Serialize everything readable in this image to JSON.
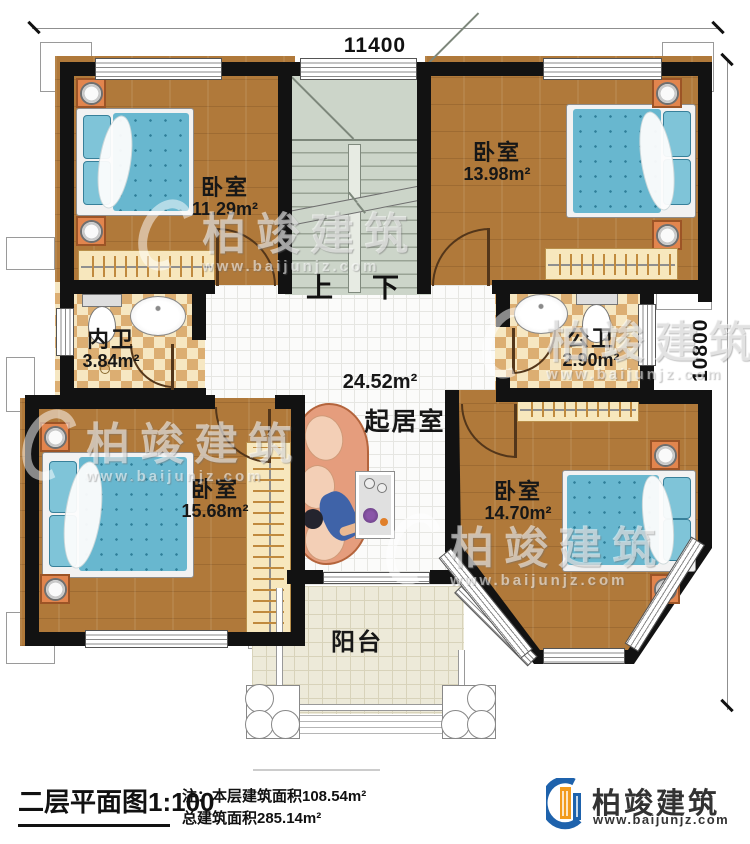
{
  "plan": {
    "dim_width": "11400",
    "dim_height": "10800",
    "stair_up": "上",
    "stair_down": "下",
    "rooms": {
      "bedroom_tl": {
        "name": "卧室",
        "area": "11.29m²"
      },
      "bedroom_tr": {
        "name": "卧室",
        "area": "13.98m²"
      },
      "bath_inner": {
        "name": "内卫",
        "area": "3.84m²"
      },
      "bath_public": {
        "name": "公卫",
        "area": "2.90m²"
      },
      "living": {
        "name": "起居室",
        "area": "24.52m²"
      },
      "bedroom_bl": {
        "name": "卧室",
        "area": "15.68m²"
      },
      "bedroom_br": {
        "name": "卧室",
        "area": "14.70m²"
      },
      "balcony": {
        "name": "阳台"
      }
    }
  },
  "watermark": {
    "brand": "柏竣建筑",
    "site": "www.baijunjz.com"
  },
  "footer": {
    "title": "二层平面图",
    "scale": "1:100",
    "note1": "注：本层建筑面积108.54m²",
    "note2": "总建筑面积285.14m²",
    "brand": "柏竣建筑",
    "site": "www.baijunjz.com"
  },
  "colors": {
    "wall": "#121212",
    "wood_floor": "#b0793a",
    "stair": "#ccd5c9",
    "bed_blue": "#68b7cf",
    "nightstand_orange": "#e2854e",
    "bath_tile": "#dcae72",
    "balcony_tile": "#edead9",
    "logo_blue": "#1e62ac",
    "logo_orange": "#f29b1d"
  }
}
